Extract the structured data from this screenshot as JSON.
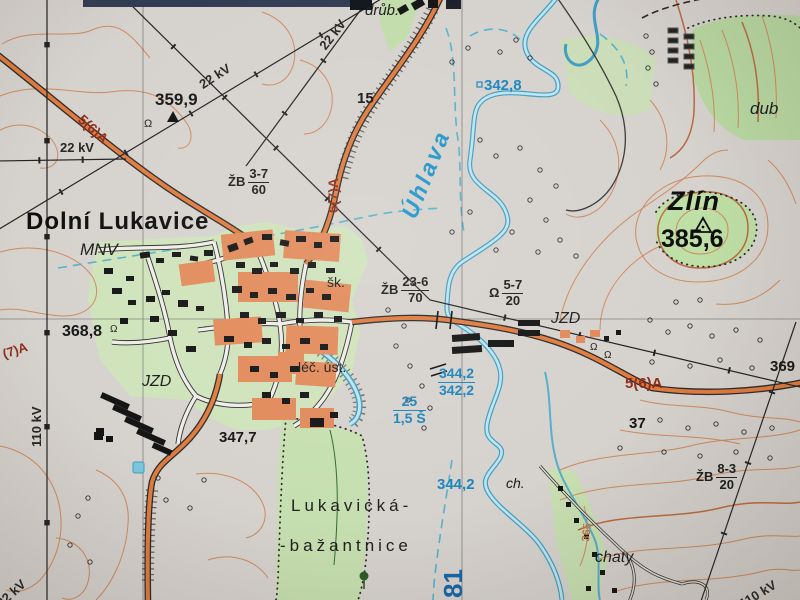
{
  "map": {
    "kind": "topographic-map-photo",
    "colors": {
      "paper": "#d6d2ce",
      "contour": "#cf8a5e",
      "contour_index": "#bb6a40",
      "water": "#3f9ec2",
      "water_label": "#1b85bd",
      "vegetation": "#c3dcab",
      "road_fill": "#e07b3e",
      "road_label": "#8e2e1a",
      "built_up": "#e28a5a",
      "label": "#1c1c1c"
    },
    "labels": [
      {
        "name": "label-farm-drub",
        "cls": "it dk",
        "size": 15,
        "text": "drůb.",
        "x": 365,
        "y": 3,
        "rot": 0
      },
      {
        "name": "label-22kv-a",
        "cls": "kv",
        "size": 13,
        "text": "22 kV",
        "x": 317,
        "y": 44,
        "rot": -52
      },
      {
        "name": "label-22kv-b",
        "cls": "kv",
        "size": 13,
        "text": "22 kV",
        "x": 197,
        "y": 80,
        "rot": -33
      },
      {
        "name": "label-road-56a-nw",
        "cls": "road",
        "size": 14,
        "text": "5(6)A",
        "x": 85,
        "y": 112,
        "rot": 42
      },
      {
        "name": "label-elev-359-9",
        "cls": "elev",
        "size": 17,
        "text": "359,9",
        "x": 155,
        "y": 91,
        "rot": 0
      },
      {
        "name": "label-15",
        "cls": "elev",
        "size": 15,
        "text": "15",
        "x": 357,
        "y": 91,
        "rot": 0
      },
      {
        "name": "label-water-342-8",
        "cls": "wat",
        "size": 15,
        "text": "342,8",
        "x": 484,
        "y": 78,
        "rot": 0
      },
      {
        "name": "label-dub",
        "cls": "it dk",
        "size": 17,
        "text": "dub",
        "x": 750,
        "y": 100,
        "rot": 0
      },
      {
        "name": "label-22kv-h",
        "cls": "kv",
        "size": 13,
        "text": "22 kV",
        "x": 60,
        "y": 141,
        "rot": 0
      },
      {
        "name": "label-bridge-zb37",
        "cls": "frac",
        "size": 13,
        "prefix": "ŽB",
        "num": "3-7",
        "den": "60",
        "x": 228,
        "y": 167,
        "rot": 0
      },
      {
        "name": "label-road-67a",
        "cls": "road",
        "size": 14,
        "text": "6(7)A",
        "x": 326,
        "y": 213,
        "rot": -90
      },
      {
        "name": "label-river-uhlava",
        "cls": "riv",
        "size": 23,
        "text": "Úhlava",
        "x": 398,
        "y": 213,
        "rot": -68
      },
      {
        "name": "label-peak-zlin",
        "cls": "peak",
        "size": 27,
        "text": "Zlín",
        "x": 668,
        "y": 188,
        "rot": 0
      },
      {
        "name": "label-elev-385-6",
        "cls": "peakelev",
        "size": 25,
        "text": "385,6",
        "x": 661,
        "y": 227,
        "rot": 0
      },
      {
        "name": "label-town-dolni-lukavice",
        "cls": "town",
        "size": 24,
        "text": "Dolní Lukavice",
        "x": 26,
        "y": 210,
        "rot": 0
      },
      {
        "name": "label-mnv",
        "cls": "it dk",
        "size": 17,
        "text": "MNV",
        "x": 80,
        "y": 241,
        "rot": 0
      },
      {
        "name": "label-elev-368-8",
        "cls": "elev",
        "size": 16,
        "text": "368,8",
        "x": 62,
        "y": 324,
        "rot": 0
      },
      {
        "name": "label-school",
        "cls": "dk",
        "size": 14,
        "text": "šk.",
        "x": 327,
        "y": 275,
        "rot": 0
      },
      {
        "name": "label-bridge-zb236",
        "cls": "frac",
        "size": 13,
        "prefix": "ŽB",
        "num": "23-6",
        "den": "70",
        "x": 381,
        "y": 275,
        "rot": 0
      },
      {
        "name": "label-bridge-5720",
        "cls": "frac",
        "size": 13,
        "prefix": "Ω",
        "num": "5-7",
        "den": "20",
        "x": 489,
        "y": 278,
        "rot": 0
      },
      {
        "name": "label-jzd-east",
        "cls": "it dk",
        "size": 16,
        "text": "JZD",
        "x": 551,
        "y": 311,
        "rot": 0
      },
      {
        "name": "label-jzd-west",
        "cls": "it dk",
        "size": 16,
        "text": "JZD",
        "x": 142,
        "y": 374,
        "rot": 0
      },
      {
        "name": "label-lec-ust",
        "cls": "dk",
        "size": 14,
        "text": "léč. úst.",
        "x": 298,
        "y": 360,
        "rot": 0
      },
      {
        "name": "label-water-344-2-342-2",
        "cls": "fracb",
        "size": 14,
        "num": "344,2",
        "den": "342,2",
        "x": 438,
        "y": 366,
        "rot": 0
      },
      {
        "name": "label-water-25-15s",
        "cls": "fracb",
        "size": 14,
        "num": "25",
        "den": "1,5 Š",
        "x": 393,
        "y": 394,
        "rot": 0
      },
      {
        "name": "label-110kv-w",
        "cls": "kv",
        "size": 13,
        "text": "110 kV",
        "x": 30,
        "y": 447,
        "rot": -90
      },
      {
        "name": "label-elev-347-7",
        "cls": "elev",
        "size": 15,
        "text": "347,7",
        "x": 219,
        "y": 430,
        "rot": 0
      },
      {
        "name": "label-road-56a-e",
        "cls": "road",
        "size": 15,
        "text": "5(6)A",
        "x": 625,
        "y": 376,
        "rot": 0
      },
      {
        "name": "label-elev-369",
        "cls": "elev",
        "size": 15,
        "text": "369",
        "x": 770,
        "y": 359,
        "rot": 0
      },
      {
        "name": "label-37",
        "cls": "elev",
        "size": 15,
        "text": "37",
        "x": 629,
        "y": 416,
        "rot": 0
      },
      {
        "name": "label-water-344-2",
        "cls": "wat",
        "size": 15,
        "text": "344,2",
        "x": 437,
        "y": 477,
        "rot": 0
      },
      {
        "name": "label-ch",
        "cls": "it dk",
        "size": 14,
        "text": "ch.",
        "x": 506,
        "y": 476,
        "rot": 0
      },
      {
        "name": "label-contour-365",
        "cls": "cont",
        "size": 11,
        "text": "365",
        "x": 581,
        "y": 541,
        "rot": -84
      },
      {
        "name": "label-forest-lukavicka",
        "cls": "forestlab",
        "size": 17,
        "text": "Lukavická-",
        "x": 291,
        "y": 497,
        "rot": 0
      },
      {
        "name": "label-forest-bazantnice",
        "cls": "forestlab",
        "size": 17,
        "text": "-bažantnice",
        "x": 280,
        "y": 537,
        "rot": 0
      },
      {
        "name": "label-river-km-81",
        "cls": "bigblue",
        "size": 26,
        "text": "81",
        "x": 440,
        "y": 598,
        "rot": -90
      },
      {
        "name": "label-chaty",
        "cls": "it dk",
        "size": 16,
        "text": "chaty",
        "x": 595,
        "y": 550,
        "rot": 0
      },
      {
        "name": "label-bridge-zb83",
        "cls": "frac",
        "size": 13,
        "prefix": "ŽB",
        "num": "8-3",
        "den": "20",
        "x": 696,
        "y": 462,
        "rot": 0
      },
      {
        "name": "label-110kv-se",
        "cls": "kv",
        "size": 13,
        "text": "110 kV",
        "x": 737,
        "y": 599,
        "rot": -31
      },
      {
        "name": "label-22kv-sw",
        "cls": "kv",
        "size": 13,
        "text": "22 kV",
        "x": -6,
        "y": 600,
        "rot": -42
      },
      {
        "name": "label-road-7a-w",
        "cls": "road",
        "size": 13,
        "text": "(7)A",
        "x": 1,
        "y": 348,
        "rot": -18
      },
      {
        "name": "sym-chapel-1",
        "cls": "dk",
        "size": 11,
        "text": "Ω",
        "x": 144,
        "y": 119,
        "rot": 0
      },
      {
        "name": "sym-chapel-2",
        "cls": "dk",
        "size": 10,
        "text": "Ω",
        "x": 110,
        "y": 325,
        "rot": 0
      },
      {
        "name": "sym-chapel-3",
        "cls": "dk",
        "size": 10,
        "text": "Ω",
        "x": 590,
        "y": 343,
        "rot": 0
      },
      {
        "name": "sym-chapel-4",
        "cls": "dk",
        "size": 10,
        "text": "Ω",
        "x": 604,
        "y": 351,
        "rot": 0
      }
    ]
  }
}
